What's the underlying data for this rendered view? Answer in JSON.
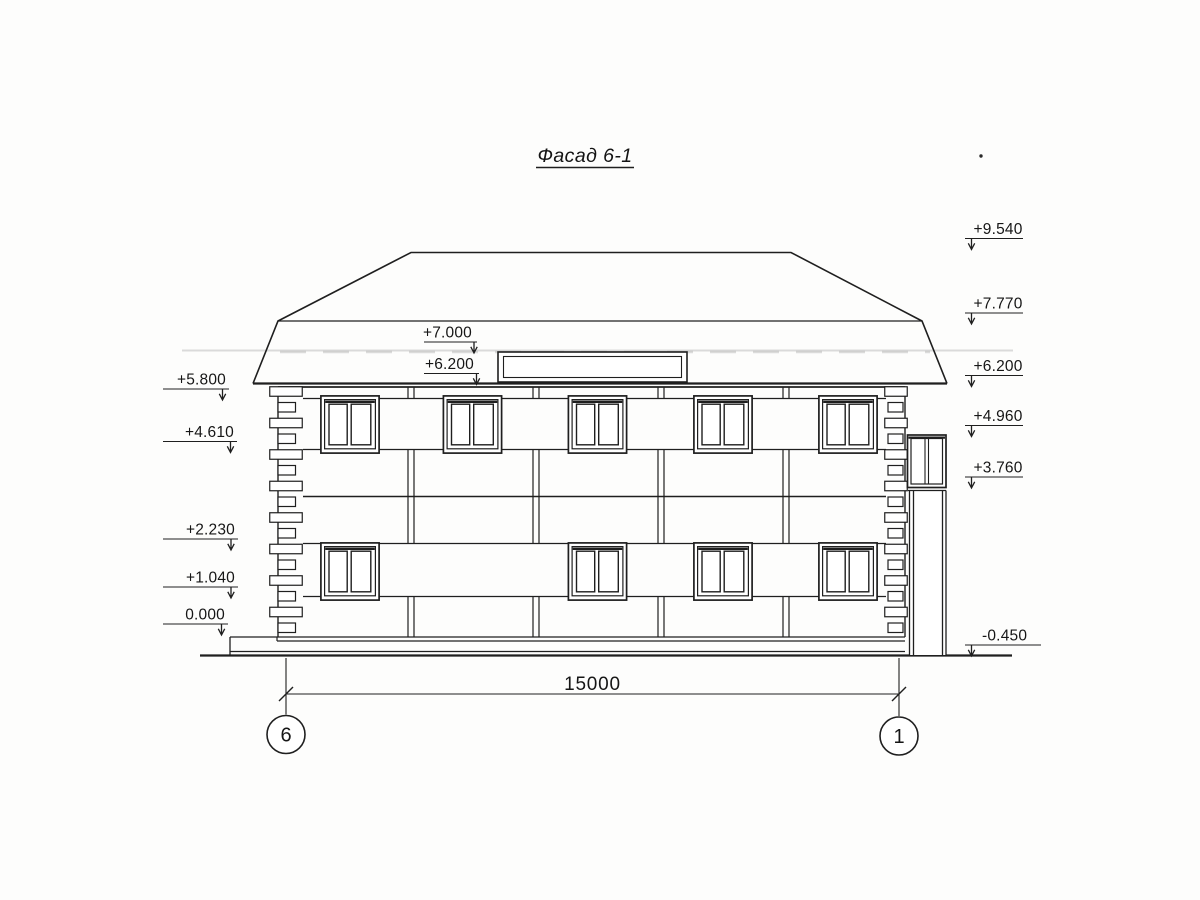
{
  "drawing": {
    "title": "Фасад 6-1",
    "dimension_label": "15000",
    "axis_left": "6",
    "axis_right": "1",
    "marks_left": [
      "+5.800",
      "+4.610",
      "+2.230",
      "+1.040",
      "0.000"
    ],
    "marks_middle": [
      "+7.000",
      "+6.200"
    ],
    "marks_right": [
      "+9.540",
      "+7.770",
      "+6.200",
      "+4.960",
      "+3.760",
      "-0.450"
    ],
    "colors": {
      "ink": "#1f1f1f",
      "paper": "#fdfdfc"
    }
  }
}
